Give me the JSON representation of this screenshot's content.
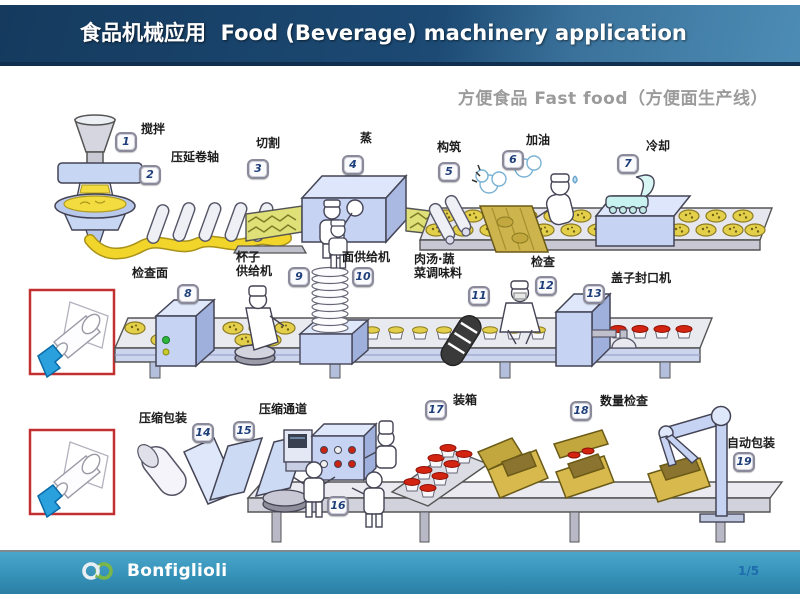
{
  "header": {
    "title": "食品机械应用  Food (Beverage) machinery application"
  },
  "subtitle": "方便食品 Fast food（方便面生产线）",
  "stations": [
    {
      "num": "1",
      "label": "搅拌"
    },
    {
      "num": "2",
      "label": "压延卷轴"
    },
    {
      "num": "3",
      "label": "切割"
    },
    {
      "num": "4",
      "label": "蒸"
    },
    {
      "num": "5",
      "label": "构筑"
    },
    {
      "num": "6",
      "label": "加油"
    },
    {
      "num": "7",
      "label": "冷却"
    },
    {
      "num": "8",
      "label": "检查面"
    },
    {
      "num": "9",
      "label": "杯子\n供给机"
    },
    {
      "num": "10",
      "label": "面供给机"
    },
    {
      "num": "11",
      "label": "肉汤·蔬\n菜调味料"
    },
    {
      "num": "12",
      "label": "检查"
    },
    {
      "num": "13",
      "label": "盖子封口机"
    },
    {
      "num": "14",
      "label": "压缩包装"
    },
    {
      "num": "15",
      "label": "压缩通道"
    },
    {
      "num": "16",
      "label": ""
    },
    {
      "num": "17",
      "label": "装箱"
    },
    {
      "num": "18",
      "label": "数量检查"
    },
    {
      "num": "19",
      "label": "自动包装"
    }
  ],
  "footer": {
    "brand": "Bonfiglioli",
    "page": "1/5"
  },
  "colors": {
    "header_dark": "#153a5e",
    "header_light": "#2d6f9c",
    "footer_teal": "#3692b8",
    "callout_red": "#c23030",
    "dough_yellow": "#e9d44a",
    "lid_red": "#d32311",
    "machine_blue": "#c6d3f3",
    "box_tan": "#d7b94e",
    "logo_green": "#7ab648"
  }
}
